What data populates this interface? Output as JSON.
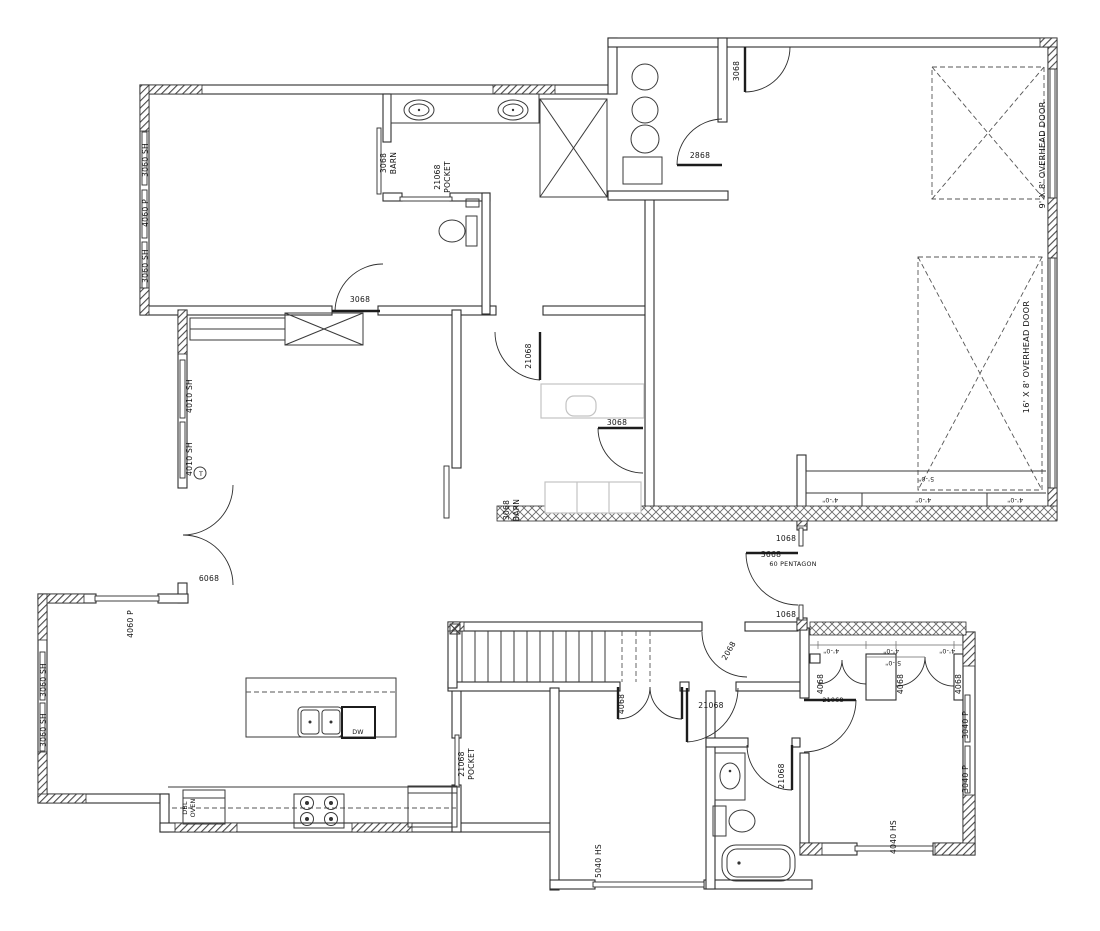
{
  "drawing": {
    "type": "architectural-floor-plan",
    "background": "#ffffff",
    "ink": "#2e2e2e",
    "furniture_gray": "#c3c3c3",
    "tempered_glass_symbol": "T",
    "appliance_labels": {
      "dishwasher": "DW",
      "double_oven_line1": "DBL",
      "double_oven_line2": "OVEN"
    }
  },
  "labels": [
    {
      "text": "3060 SH",
      "x": 148,
      "y": 160,
      "r": -90,
      "cls": "lbl"
    },
    {
      "text": "4060 P",
      "x": 148,
      "y": 213,
      "r": -90,
      "cls": "lbl"
    },
    {
      "text": "3060 SH",
      "x": 148,
      "y": 266,
      "r": -90,
      "cls": "lbl"
    },
    {
      "text": "3068",
      "x": 386,
      "y": 163,
      "r": -90,
      "cls": "lbl"
    },
    {
      "text": "BARN",
      "x": 396,
      "y": 163,
      "r": -90,
      "cls": "lbl"
    },
    {
      "text": "21068",
      "x": 440,
      "y": 177,
      "r": -90,
      "cls": "lbl"
    },
    {
      "text": "POCKET",
      "x": 450,
      "y": 177,
      "r": -90,
      "cls": "lbl"
    },
    {
      "text": "3068",
      "x": 360,
      "y": 302,
      "r": 0,
      "cls": "lbl"
    },
    {
      "text": "2868",
      "x": 700,
      "y": 158,
      "r": 0,
      "cls": "lbl"
    },
    {
      "text": "3068",
      "x": 739,
      "y": 71,
      "r": -90,
      "cls": "lbl"
    },
    {
      "text": "9' X 8' OVERHEAD DOOR",
      "x": 1045,
      "y": 155,
      "r": -90,
      "cls": "lbl big"
    },
    {
      "text": "16' X 8' OVERHEAD DOOR",
      "x": 1029,
      "y": 357,
      "r": -90,
      "cls": "lbl big"
    },
    {
      "text": "5'-0\"",
      "x": 926,
      "y": 477,
      "r": 180,
      "cls": "lbl small"
    },
    {
      "text": "4'-0\"",
      "x": 830,
      "y": 498,
      "r": 180,
      "cls": "lbl small"
    },
    {
      "text": "4'-0\"",
      "x": 923,
      "y": 498,
      "r": 180,
      "cls": "lbl small"
    },
    {
      "text": "4'-0\"",
      "x": 1015,
      "y": 498,
      "r": 180,
      "cls": "lbl small"
    },
    {
      "text": "4010 SH",
      "x": 192,
      "y": 396,
      "r": -90,
      "cls": "lbl"
    },
    {
      "text": "4010 SH",
      "x": 192,
      "y": 459,
      "r": -90,
      "cls": "lbl"
    },
    {
      "text": "T",
      "x": 201,
      "y": 476,
      "r": 0,
      "cls": "lbl small"
    },
    {
      "text": "21068",
      "x": 531,
      "y": 356,
      "r": -90,
      "cls": "lbl"
    },
    {
      "text": "3068",
      "x": 617,
      "y": 425,
      "r": 0,
      "cls": "lbl"
    },
    {
      "text": "3068",
      "x": 509,
      "y": 510,
      "r": -90,
      "cls": "lbl"
    },
    {
      "text": "BARN",
      "x": 519,
      "y": 510,
      "r": -90,
      "cls": "lbl"
    },
    {
      "text": "1068",
      "x": 786,
      "y": 541,
      "r": 0,
      "cls": "lbl"
    },
    {
      "text": "3668",
      "x": 771,
      "y": 557,
      "r": 0,
      "cls": "lbl"
    },
    {
      "text": "60 PENTAGON",
      "x": 793,
      "y": 566,
      "r": 0,
      "cls": "lbl small"
    },
    {
      "text": "1068",
      "x": 786,
      "y": 617,
      "r": 0,
      "cls": "lbl"
    },
    {
      "text": "6068",
      "x": 209,
      "y": 581,
      "r": 0,
      "cls": "lbl"
    },
    {
      "text": "4060 P",
      "x": 133,
      "y": 624,
      "r": -90,
      "cls": "lbl"
    },
    {
      "text": "3060 SH",
      "x": 46,
      "y": 680,
      "r": -90,
      "cls": "lbl"
    },
    {
      "text": "3060 SH",
      "x": 46,
      "y": 730,
      "r": -90,
      "cls": "lbl"
    },
    {
      "text": "DW",
      "x": 358,
      "y": 734,
      "r": 0,
      "cls": "lbl small"
    },
    {
      "text": "DBL",
      "x": 187,
      "y": 808,
      "r": -90,
      "cls": "lbl small"
    },
    {
      "text": "OVEN",
      "x": 195,
      "y": 808,
      "r": -90,
      "cls": "lbl small"
    },
    {
      "text": "21068",
      "x": 464,
      "y": 764,
      "r": -90,
      "cls": "lbl"
    },
    {
      "text": "POCKET",
      "x": 474,
      "y": 764,
      "r": -90,
      "cls": "lbl"
    },
    {
      "text": "4068",
      "x": 624,
      "y": 704,
      "r": -90,
      "cls": "lbl"
    },
    {
      "text": "2068",
      "x": 731,
      "y": 652,
      "r": -60,
      "cls": "lbl"
    },
    {
      "text": "21068",
      "x": 711,
      "y": 708,
      "r": 0,
      "cls": "lbl"
    },
    {
      "text": "5040 HS",
      "x": 601,
      "y": 861,
      "r": -90,
      "cls": "lbl"
    },
    {
      "text": "21068",
      "x": 784,
      "y": 776,
      "r": -90,
      "cls": "lbl"
    },
    {
      "text": "4'-0\"",
      "x": 831,
      "y": 649,
      "r": 180,
      "cls": "lbl small"
    },
    {
      "text": "4'-0\"",
      "x": 891,
      "y": 649,
      "r": 180,
      "cls": "lbl small"
    },
    {
      "text": "4'-0\"",
      "x": 947,
      "y": 649,
      "r": 180,
      "cls": "lbl small"
    },
    {
      "text": "5'-0\"",
      "x": 893,
      "y": 661,
      "r": 180,
      "cls": "lbl small"
    },
    {
      "text": "4068",
      "x": 823,
      "y": 684,
      "r": -90,
      "cls": "lbl"
    },
    {
      "text": "4068",
      "x": 903,
      "y": 684,
      "r": -90,
      "cls": "lbl"
    },
    {
      "text": "4068",
      "x": 961,
      "y": 684,
      "r": -90,
      "cls": "lbl"
    },
    {
      "text": "21068",
      "x": 833,
      "y": 702,
      "r": 0,
      "cls": "lbl small"
    },
    {
      "text": "3040 P",
      "x": 968,
      "y": 725,
      "r": -90,
      "cls": "lbl"
    },
    {
      "text": "3040 P",
      "x": 968,
      "y": 779,
      "r": -90,
      "cls": "lbl"
    },
    {
      "text": "4040 HS",
      "x": 896,
      "y": 837,
      "r": -90,
      "cls": "lbl"
    }
  ]
}
